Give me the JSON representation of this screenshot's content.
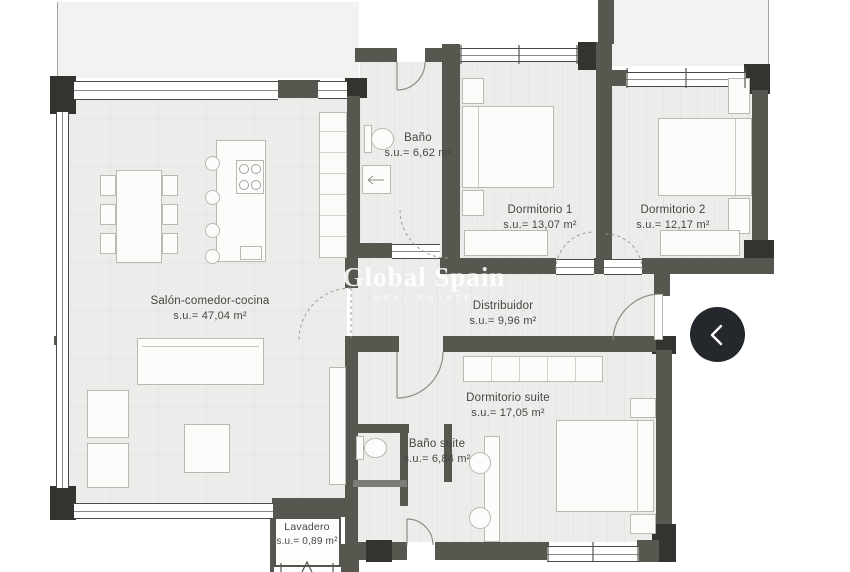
{
  "rooms": [
    {
      "name": "Salón-comedor-cocina",
      "area": "s.u.= 47,04 m²"
    },
    {
      "name": "Baño",
      "area": "s.u.= 6,62 m²"
    },
    {
      "name": "Dormitorio 1",
      "area": "s.u.= 13,07 m²"
    },
    {
      "name": "Dormitorio 2",
      "area": "s.u.= 12,17 m²"
    },
    {
      "name": "Distribuidor",
      "area": "s.u.= 9,96 m²"
    },
    {
      "name": "Dormitorio suite",
      "area": "s.u.= 17,05 m²"
    },
    {
      "name": "Baño suite",
      "area": "s.u.= 6,84 m²"
    },
    {
      "name": "Lavadero",
      "area": "s.u.= 0,89 m²"
    }
  ],
  "watermark": {
    "title": "Global Spain",
    "subtitle": "REAL ESTATE"
  },
  "icons": {
    "nav_previous": "chevron-left"
  },
  "colors": {
    "wall": "#57564f",
    "pillar": "#34332f",
    "floor": "#edecea",
    "terrace": "#f3f2f0",
    "nav_button": "#24272c",
    "watermark_text": "#ffffff"
  }
}
